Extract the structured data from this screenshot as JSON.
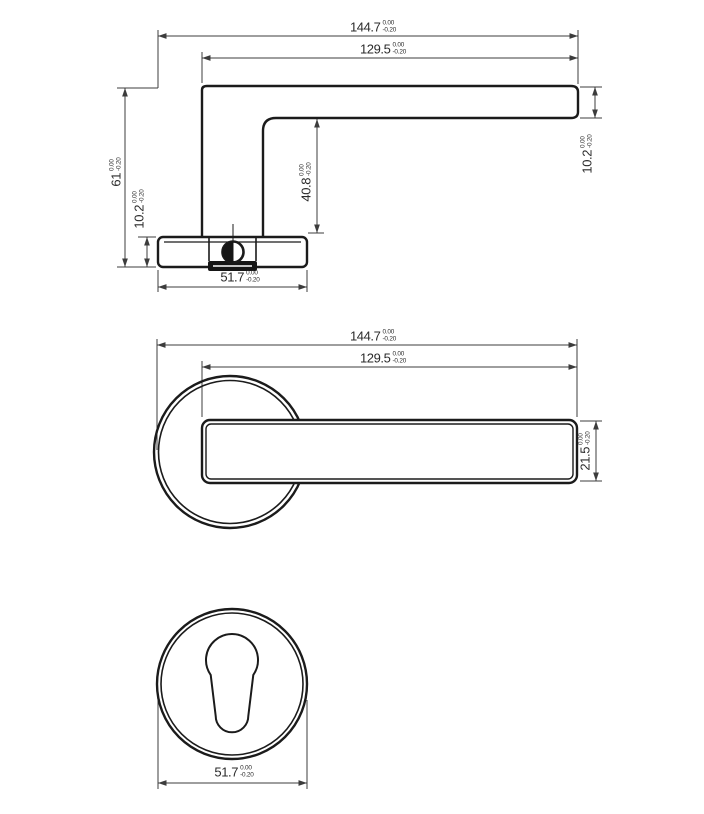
{
  "drawing": {
    "kind": "lever-door-handle-technical-drawing",
    "background": "#ffffff",
    "object_line_color": "#1b1b1b",
    "dimension_line_color": "#3c3c3c",
    "text_color": "#2b2b2b"
  },
  "side_view": {
    "overall_length": {
      "value": "144.7",
      "tol_top": "0.00",
      "tol_bottom": "-0.20"
    },
    "lever_length": {
      "value": "129.5",
      "tol_top": "0.00",
      "tol_bottom": "-0.20"
    },
    "overall_height": {
      "value": "61",
      "tol_top": "0.00",
      "tol_bottom": "-0.20"
    },
    "rose_height": {
      "value": "10.2",
      "tol_top": "0.00",
      "tol_bottom": "-0.20"
    },
    "neck_height": {
      "value": "40.8",
      "tol_top": "0.00",
      "tol_bottom": "-0.20"
    },
    "lever_thickness": {
      "value": "10.2",
      "tol_top": "0.00",
      "tol_bottom": "-0.20"
    },
    "rose_width": {
      "value": "51.7",
      "tol_top": "0.00",
      "tol_bottom": "-0.20"
    }
  },
  "front_view": {
    "overall_length": {
      "value": "144.7",
      "tol_top": "0.00",
      "tol_bottom": "-0.20"
    },
    "lever_length": {
      "value": "129.5",
      "tol_top": "0.00",
      "tol_bottom": "-0.20"
    },
    "lever_width": {
      "value": "21.5",
      "tol_top": "0.00",
      "tol_bottom": "-0.20"
    }
  },
  "escutcheon_view": {
    "rose_diameter": {
      "value": "51.7",
      "tol_top": "0.00",
      "tol_bottom": "-0.20"
    }
  }
}
